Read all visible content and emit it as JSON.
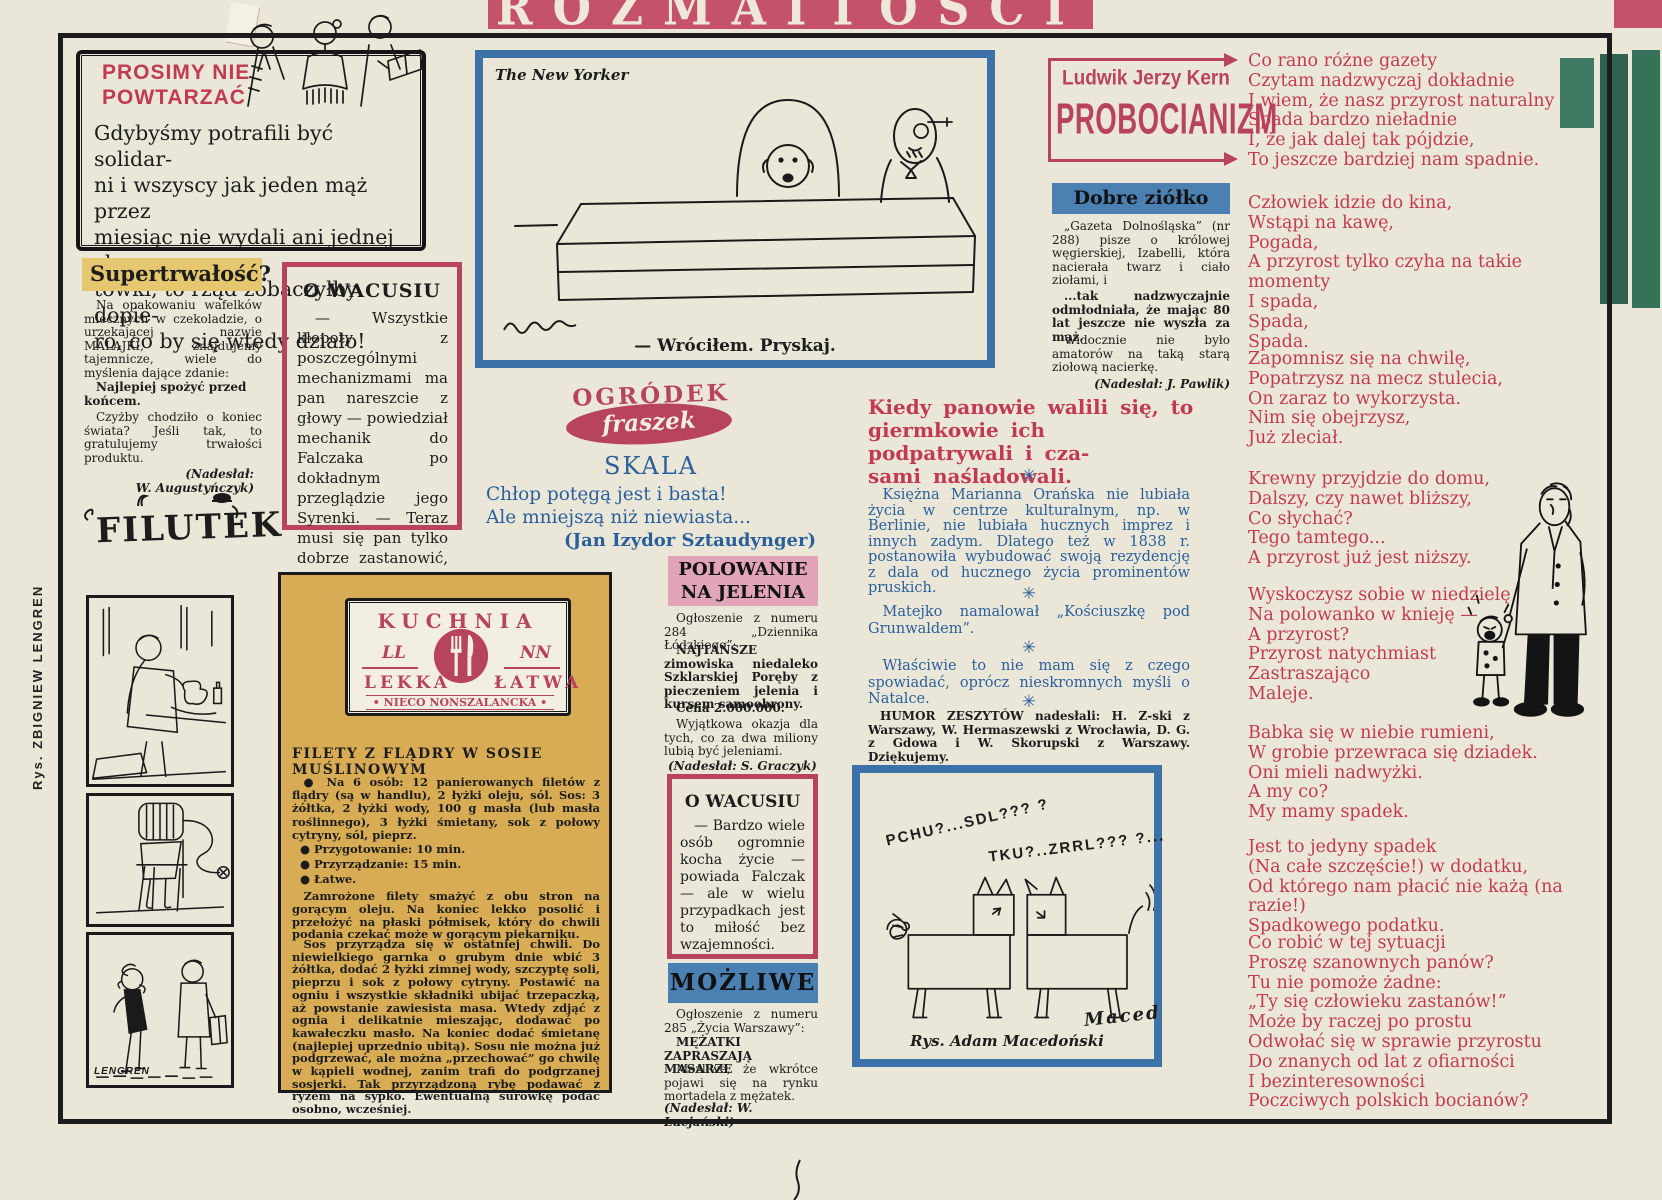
{
  "banner": {
    "title": "ROZMAITOŚCI"
  },
  "margin": {
    "artist_credit": "Rys. ZBIGNIEW LENGREN"
  },
  "colors": {
    "banner_pink": "#c4526b",
    "crimson": "#b8435c",
    "red_text": "#c23a52",
    "blue_border": "#3d72a8",
    "blue_panel": "#4b80b3",
    "pink_panel": "#e2a4b8",
    "mustard": "#d8ac55",
    "yellow_highlight": "#e5c76f",
    "blue_text": "#2b5f9b",
    "paper": "#eae7d8",
    "ink": "#1c1c1c",
    "green_strip": "#2e6150"
  },
  "prosimy": {
    "title": "PROSIMY NIE\nPOWTARZAĆ",
    "body": "Gdybyśmy potrafili być solidar-\nni i wszyscy jak jeden mąż przez\nmiesiąc nie wydali ani jednej zło-\ntówki, to rząd zobaczyłby dopie-\nro, co by się wtedy działo!"
  },
  "supertrwalosc": {
    "title": "Supertrwałość?",
    "p1": "Na opakowaniu wafelków mlecznych w czekoladzie, o urzekającej nazwie MALAJKI, znajdujemy tajemnicze, wiele do myślenia dające zdanie:",
    "p2": "Najlepiej spożyć przed końcem.",
    "p3": "Czyżby chodziło o koniec świata? Jeśli tak, to gratulujemy trwałości produktu.",
    "credit": "(Nadesłał:\nW. Augustyńczyk)"
  },
  "wacusiu1": {
    "title": "O WACUSIU",
    "body": "— Wszystkie kłopoty z poszczególnymi mechanizmami ma pan nareszcie z głowy — powiedział mechanik do Falczaka po dokładnym przeglądzie jego Syrenki. — Teraz musi się pan tylko dobrze zastanowić, gdzie tego grata porzucić."
  },
  "filutek": {
    "logo": "FILUTEK",
    "signature": "LENGREN"
  },
  "newyorker": {
    "source": "The New Yorker",
    "caption": "— Wróciłem. Pryskaj."
  },
  "fraszki": {
    "logo_line1": "OGRÓDEK",
    "logo_line2": "fraszek",
    "title": "SKALA",
    "line1": "Chłop potęgą jest i basta!",
    "line2": "Ale mniejszą niż niewiasta...",
    "author": "(Jan Izydor Sztaudynger)"
  },
  "kuchnia": {
    "logo_title": "KUCHNIA",
    "logo_ll": "LL",
    "logo_nn": "NN",
    "logo_left": "LEKKA",
    "logo_right": "ŁATWA",
    "logo_sub": "• NIECO NONSZALANCKA •",
    "recipe_title": "FILETY Z FLĄDRY W SOSIE MUŚLINOWYM",
    "ingredients": "● Na 6 osób: 12 panierowanych filetów z flądry (są w handlu), 2 łyżki oleju, sól. Sos: 3 żółtka, 2 łyżki wody, 100 g masła (lub masła roślinnego), 3 łyżki śmietany, sok z połowy cytryny, sól, pieprz.",
    "bullet1": "● Przygotowanie: 10 min.",
    "bullet2": "● Przyrządzanie: 15 min.",
    "bullet3": "● Łatwe.",
    "para1": "Zamrożone filety smażyć z obu stron na gorącym oleju. Na koniec lekko posolić i przełożyć na płaski półmisek, który do chwili podania czekać może w gorącym piekarniku.",
    "para2": "Sos przyrządza się w ostatniej chwili. Do niewielkiego garnka o grubym dnie wbić 3 żółtka, dodać 2 łyżki zimnej wody, szczyptę soli, pieprzu i sok z połowy cytryny. Postawić na ogniu i wszystkie składniki ubijać trzepaczką, aż powstanie zawiesista masa. Wtedy zdjąć z ognia i delikatnie mieszając, dodawać po kawałeczku masło. Na koniec dodać śmietanę (najlepiej uprzednio ubitą). Sosu nie można już podgrzewać, ale można „przechować” go chwilę w kąpieli wodnej, zanim trafi do podgrzanej sosjerki. Tak przyrządzoną rybę podawać z ryżem na sypko. Ewentualną surówkę podać osobno, wcześniej."
  },
  "polowanie": {
    "title": "POLOWANIE\nNA JELENIA",
    "p1": "Ogłoszenie z numeru 284 „Dziennika Łódzkiego”:",
    "p2": "NAJTAŃSZE zimowiska niedaleko Szklarskiej Poręby z pieczeniem jelenia i kursem samoobrony.",
    "p3": "Cena 2.000.000.",
    "p4": "Wyjątkowa okazja dla tych, co za dwa miliony lubią być jeleniami.",
    "credit": "(Nadesłał: S. Graczyk)"
  },
  "wacusiu2": {
    "title": "O WACUSIU",
    "body": "— Bardzo wiele osób ogromnie kocha życie — powiada Falczak — ale w wielu przypadkach jest to miłość bez wzajemności."
  },
  "mozliwe": {
    "title": "MOŻLIWE",
    "p1": "Ogłoszenie z numeru 285 „Życia Warszawy”:",
    "p2": "MĘŻATKI ZAPRASZAJĄ MASARZE",
    "p3": "Możliwe, że wkrótce pojawi się na rynku mortadela z mężatek.",
    "credit": "(Nadesłał: W. Lucjański)"
  },
  "kern": {
    "author": "Ludwik Jerzy Kern",
    "title": "PROBOCIANIZM"
  },
  "ziolko": {
    "title": "Dobre ziółko",
    "p1": "„Gazeta Dolnośląska” (nr 288) pisze o królowej węgierskiej, Izabelli, która nacierała twarz i ciało ziołami, i",
    "p2": "...tak nadzwyczajnie odmłodniała, że mając 80 lat jeszcze nie wyszła za mąż.",
    "p3": "Widocznie nie było amatorów na taką starą ziołową nacierkę.",
    "credit": "(Nadesłał: J. Pawlik)"
  },
  "humor": {
    "lead": "Kiedy panowie walili się, to\ngiermkowie ich podpatrywali i cza-\nsami naśladowali.",
    "separator": "✳",
    "item1": "Księżna Marianna Orańska nie lubiała życia w centrze kulturalnym, np. w Berlinie, nie lubiała hucznych imprez i innych zadym. Dlatego też w 1838 r. postanowiła wybudować swoją rezydencję z dala od hucznego życia prominentów pruskich.",
    "item2": "Matejko namalował „Kościuszkę pod Grunwaldem”.",
    "item3": "Właściwie to nie mam się z czego spowiadać, oprócz nieskromnych myśli o Natalce.",
    "credit": "HUMOR ZESZYTÓW nadesłali: H. Z-ski z Warszawy, W. Hermaszewski z Wrocławia, D. G. z Gdowa i W. Skorupski z Warszawy. Dziękujemy."
  },
  "macedonski": {
    "sound1": "PCHU?...SDL??? ?",
    "sound2": "TKU?..ZRRL??? ?...",
    "signature": "Maced",
    "caption": "Rys. Adam Macedoński"
  },
  "poem": {
    "stanzas": [
      "Co rano różne gazety\nCzytam nadzwyczaj dokładnie\nI wiem, że nasz przyrost naturalny\nSpada bardzo nieładnie\nI, że jak dalej tak pójdzie,\nTo jeszcze bardziej nam spadnie.",
      "Człowiek idzie do kina,\nWstąpi na kawę,\nPogada,\nA przyrost tylko czyha na takie momenty\nI spada,\nSpada,\nSpada.",
      "Zapomnisz się na chwilę,\nPopatrzysz na mecz stulecia,\nOn zaraz to wykorzysta.\nNim się obejrzysz,\nJuż zleciał.",
      "Krewny przyjdzie do domu,\nDalszy, czy nawet bliższy,\nCo słychać?\nTego tamtego...\nA przyrost już jest niższy.",
      "Wyskoczysz sobie w niedzielę\nNa polowanko w knieję —\nA przyrost?\nPrzyrost natychmiast\nZastraszająco\nMaleje.",
      "Babka się w niebie rumieni,\nW grobie przewraca się dziadek.\nOni mieli nadwyżki.\nA my co?\nMy mamy spadek.",
      "Jest to jedyny spadek\n(Na całe szczęście!) w dodatku,\nOd którego nam płacić nie każą (na razie!)\nSpadkowego podatku.",
      "Co robić w tej sytuacji\nProszę szanownych panów?\nTu nie pomoże żadne:\n„Ty się człowieku zastanów!”\nMoże by raczej po prostu\nOdwołać się w sprawie przyrostu\nDo znanych od lat z ofiarności\nI bezinteresowności\nPoczciwych polskich bocianów?"
    ]
  }
}
